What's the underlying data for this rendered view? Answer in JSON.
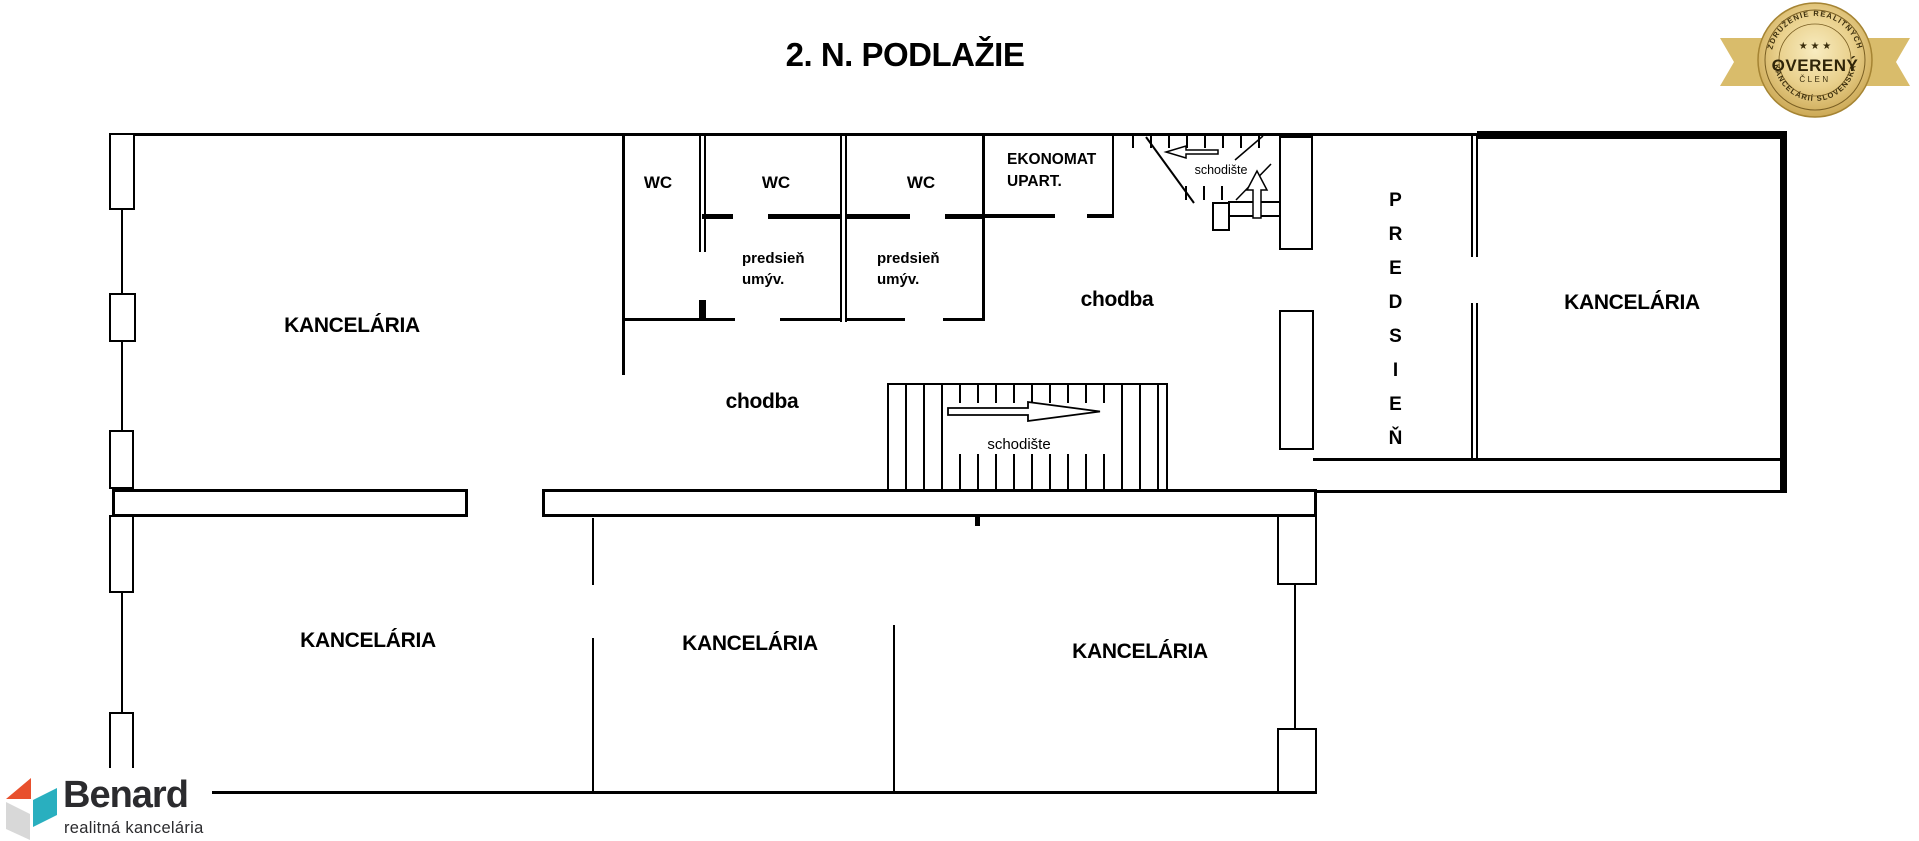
{
  "title": "2. N. PODLAŽIE",
  "rooms": {
    "office_top_left": "KANCELÁRIA",
    "office_right": "KANCELÁRIA",
    "office_bottom_left": "KANCELÁRIA",
    "office_bottom_middle": "KANCELÁRIA",
    "office_bottom_right": "KANCELÁRIA",
    "wc_1": "WC",
    "wc_2": "WC",
    "wc_3": "WC",
    "vestibule_1_line1": "predsieň",
    "vestibule_1_line2": "umýv.",
    "vestibule_2_line1": "predsieň",
    "vestibule_2_line2": "umýv.",
    "ekonomat_line1": "EKONOMAT",
    "ekonomat_line2": "UPART.",
    "corridor_upper": "chodba",
    "corridor_lower": "chodba",
    "staircase_upper": "schodište",
    "staircase_lower": "schodište",
    "hall_vertical": "PREDSIEŇ"
  },
  "badge": {
    "arc_top": "ZDRUŽENIE REALITNÝCH",
    "arc_bottom": "KANCELÁRIÍ SLOVENSKA",
    "stars": "★ ★ ★",
    "main": "OVERENÝ",
    "sub": "ČLEN",
    "gold": "#D9BC6B",
    "gold_dark": "#B5954A",
    "text_color": "#3A2D0C"
  },
  "logo": {
    "name": "Benard",
    "tagline": "realitná kancelária",
    "orange": "#E8502D",
    "teal": "#29AFBF",
    "gray": "#D8D8D8",
    "text_color": "#2B2B2E"
  },
  "plan": {
    "wall_color": "#000000",
    "background": "#FFFFFF"
  }
}
